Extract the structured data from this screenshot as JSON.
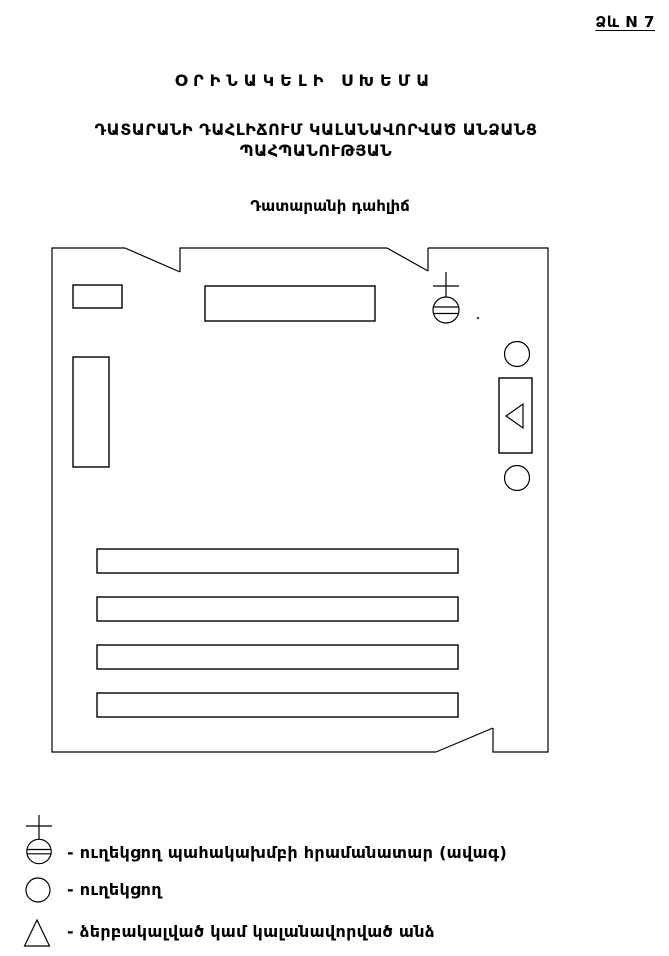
{
  "header": {
    "form_number": "Ձև N 7",
    "title": "ՕՐԻՆԱԿԵԼԻ ՍԽԵՄԱ",
    "subtitle_line1": "ԴԱՏԱՐԱՆԻ ԴԱՀԼԻՃՈՒՄ ԿԱԼԱՆԱՎՈՐՎԱԾ ԱՆՁԱՆՑ",
    "subtitle_line2": "ՊԱՀՊԱՆՈՒԹՅԱՆ",
    "room_label": "Դատարանի դահլիճ"
  },
  "diagram": {
    "symbols": {
      "commander": "circle-with-cross-and-double-bar",
      "escort": "empty-circle",
      "detainee": "triangle"
    }
  },
  "legend": {
    "items": [
      {
        "symbol": "commander-symbol",
        "label": "- ուղեկցող պահակախմբի  հրամանատար  (ավագ)"
      },
      {
        "symbol": "escort-circle",
        "label": "- ուղեկցող"
      },
      {
        "symbol": "detainee-triangle",
        "label": "- ձերբակալված  կամ  կալանավորված  անձ"
      }
    ]
  },
  "colors": {
    "ink": "#000000",
    "paper": "#ffffff"
  }
}
